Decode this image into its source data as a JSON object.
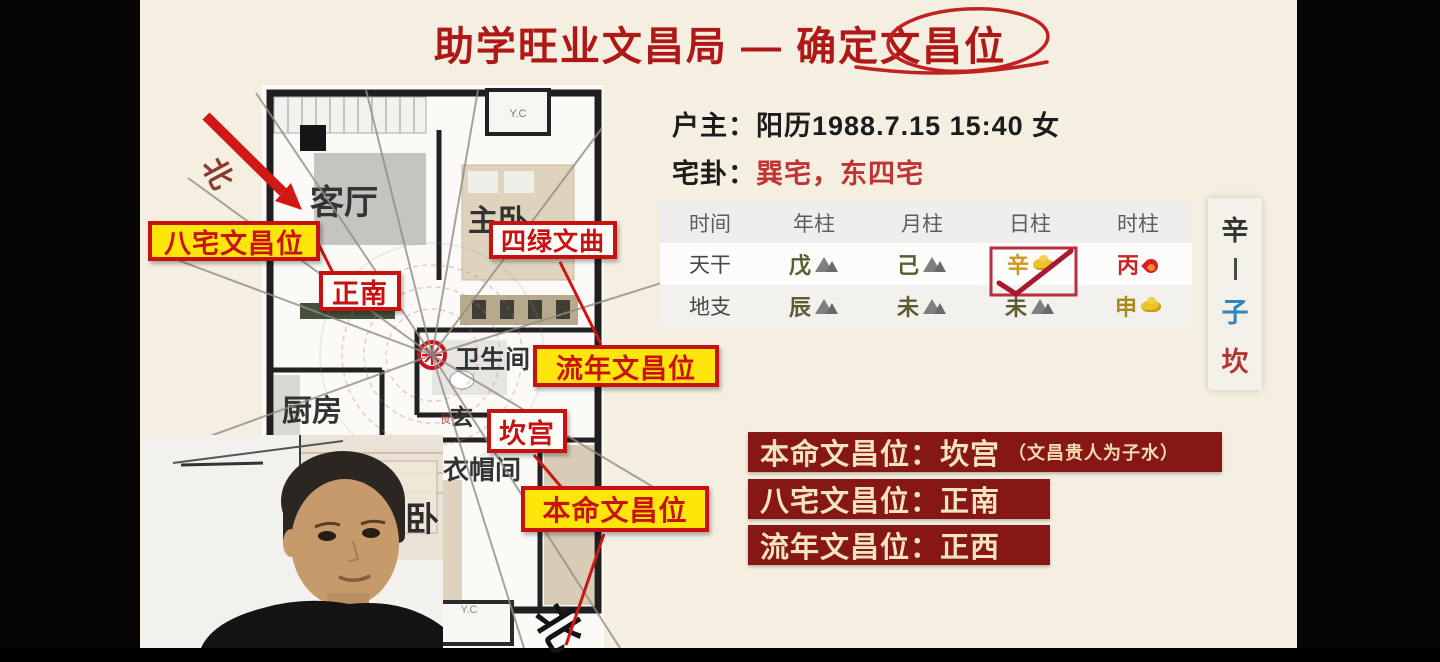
{
  "title": {
    "prefix": "助学旺业文昌局 — 确定",
    "circled": "文昌位"
  },
  "household": {
    "owner_label": "户主：",
    "owner_value": "阳历1988.7.15 15:40 女",
    "gua_label": "宅卦：",
    "gua_value": "巽宅，东四宅"
  },
  "pillar_table": {
    "headers": [
      "时间",
      "年柱",
      "月柱",
      "日柱",
      "时柱"
    ],
    "rows": [
      {
        "name": "天干",
        "cells": [
          {
            "char": "戊",
            "icon": "mountain-icon",
            "element": "earth"
          },
          {
            "char": "己",
            "icon": "mountain-icon",
            "element": "earth"
          },
          {
            "char": "辛",
            "icon": "gold-icon",
            "element": "metal",
            "highlighted": true
          },
          {
            "char": "丙",
            "icon": "fire-icon",
            "element": "fire"
          }
        ]
      },
      {
        "name": "地支",
        "cells": [
          {
            "char": "辰",
            "icon": "mountain-icon",
            "element": "earth"
          },
          {
            "char": "未",
            "icon": "mountain-icon",
            "element": "earth"
          },
          {
            "char": "未",
            "icon": "mountain-icon",
            "element": "earth"
          },
          {
            "char": "申",
            "icon": "gold-icon",
            "element": "metal"
          }
        ]
      }
    ]
  },
  "day_master_strip": {
    "top": "辛",
    "middle": "子",
    "bottom": "坎"
  },
  "floor_plan": {
    "north_label": "北",
    "vent_label": "Y.C",
    "ring_char": "艮",
    "rooms": {
      "living": "客厅",
      "master": "主卧",
      "bathroom": "卫生间",
      "kitchen": "厨房",
      "foyer": "玄",
      "cloakroom": "衣帽间",
      "second_bedroom": "次卧"
    }
  },
  "callouts": {
    "bazhai": "八宅文昌位",
    "south": "正南",
    "silu": "四绿文曲",
    "liunian": "流年文昌位",
    "kan_palace": "坎宫",
    "benming": "本命文昌位"
  },
  "summary": [
    {
      "label": "本命文昌位：",
      "value": "坎宫",
      "note": "（文昌贵人为子水）"
    },
    {
      "label": "八宅文昌位：",
      "value": "正南",
      "note": ""
    },
    {
      "label": "流年文昌位：",
      "value": "正西",
      "note": ""
    }
  ],
  "colors": {
    "background": "#f4efe0",
    "pillarbox": "#050505",
    "title_red": "#b01818",
    "callout_red": "#c81111",
    "callout_yellow": "#ffe60a",
    "banner_bg": "#871617",
    "banner_text": "#f3e4bf",
    "earth_text": "#5c5c30",
    "metal_text": "#d4951c",
    "fire_text": "#c62525",
    "zi_blue": "#2e86c1",
    "kan_red": "#b03434"
  }
}
